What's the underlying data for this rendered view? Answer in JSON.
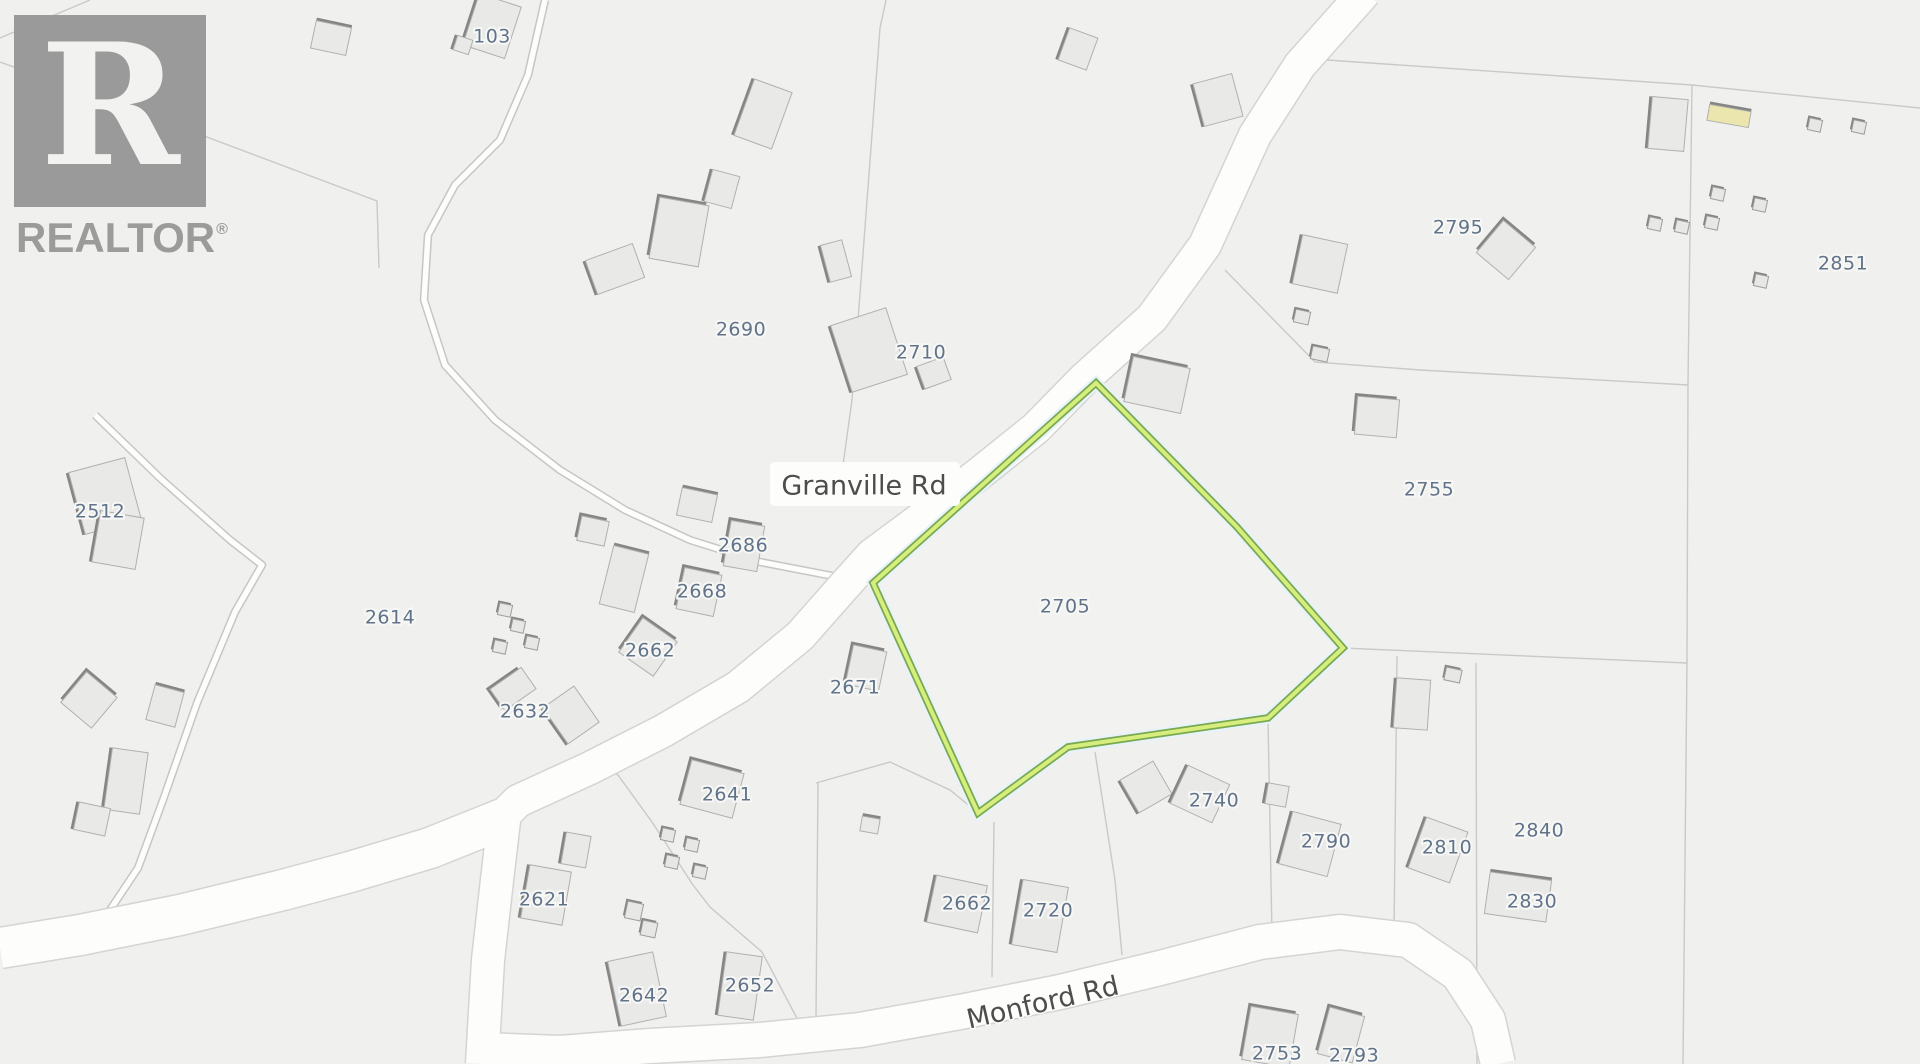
{
  "logo": {
    "letter": "R",
    "text": "REALTOR",
    "reg": "®",
    "color": "#9b9b99"
  },
  "map": {
    "background": "#f0f0ee",
    "parcel_fill": "#f2f2f0",
    "parcel_line_color": "#c9c9c7",
    "road_fill": "#fdfdfc",
    "road_casing": "#d4d4d2",
    "lane_casing": "#c6c6c4",
    "house_fill": "#e9e9e7",
    "house_stroke": "#b0b0ae",
    "house_accent": "#858583",
    "shed_fill": "#e7e7e5",
    "shed_stroke": "#9d9d9b",
    "label_color": "#60738a",
    "road_label_color": "#4d4d4b",
    "highlight_outer": "#79a94f",
    "highlight_inner": "#d7ee7e",
    "highlight_halo": "#e8f2fa"
  },
  "highlight_parcel": {
    "id": "2705",
    "points": "1096,383 1237,527 1343,648 1268,718 1068,747 978,813 873,583"
  },
  "road_labels": [
    {
      "text": "Granville Rd",
      "x": 864,
      "y": 487,
      "rot": 0,
      "pill": {
        "x": 770,
        "y": 462,
        "w": 190,
        "h": 44
      }
    },
    {
      "text": "Monford Rd",
      "x": 1043,
      "y": 1004,
      "rot": -13
    }
  ],
  "parcel_labels": [
    {
      "text": "103",
      "x": 492,
      "y": 37
    },
    {
      "text": "2690",
      "x": 741,
      "y": 330
    },
    {
      "text": "2710",
      "x": 921,
      "y": 353
    },
    {
      "text": "2795",
      "x": 1458,
      "y": 228
    },
    {
      "text": "2851",
      "x": 1843,
      "y": 264
    },
    {
      "text": "2755",
      "x": 1429,
      "y": 490
    },
    {
      "text": "2705",
      "x": 1065,
      "y": 607
    },
    {
      "text": "2512",
      "x": 100,
      "y": 512
    },
    {
      "text": "2614",
      "x": 390,
      "y": 618
    },
    {
      "text": "2686",
      "x": 743,
      "y": 546
    },
    {
      "text": "2668",
      "x": 702,
      "y": 592
    },
    {
      "text": "2662",
      "x": 650,
      "y": 651
    },
    {
      "text": "2632",
      "x": 525,
      "y": 712
    },
    {
      "text": "2671",
      "x": 855,
      "y": 688
    },
    {
      "text": "2641",
      "x": 727,
      "y": 795
    },
    {
      "text": "2621",
      "x": 544,
      "y": 900
    },
    {
      "text": "2642",
      "x": 644,
      "y": 996
    },
    {
      "text": "2652",
      "x": 750,
      "y": 986
    },
    {
      "text": "2662",
      "x": 967,
      "y": 904
    },
    {
      "text": "2720",
      "x": 1048,
      "y": 911
    },
    {
      "text": "2740",
      "x": 1214,
      "y": 801
    },
    {
      "text": "2790",
      "x": 1326,
      "y": 842
    },
    {
      "text": "2810",
      "x": 1447,
      "y": 848
    },
    {
      "text": "2840",
      "x": 1539,
      "y": 831
    },
    {
      "text": "2830",
      "x": 1532,
      "y": 902
    },
    {
      "text": "2753",
      "x": 1277,
      "y": 1054
    },
    {
      "text": "2793",
      "x": 1354,
      "y": 1056
    }
  ],
  "roads": [
    {
      "name": "granville-rd",
      "w": 32,
      "d": "M1365,-8 L1300,65 L1255,135 L1205,245 L1152,318 L1085,378 L1036,428 L980,473 L930,512 L872,555 L845,585 L800,636 L738,687 L663,731 L588,769 L518,801 L505,814"
    },
    {
      "name": "junction-south",
      "w": 32,
      "d": "M505,812 L497,880 L488,960 L482,1064"
    },
    {
      "name": "west-road",
      "w": 40,
      "d": "M505,818 L430,848 L350,872 L283,890 L180,915 L80,935 L0,948"
    },
    {
      "name": "monford-rd",
      "w": 34,
      "d": "M482,1050 L560,1053 L650,1046 L760,1040 L860,1030 L960,1012 L1060,992 L1160,968 L1260,942 L1340,932 L1408,940 L1458,974 L1488,1020 L1498,1064"
    }
  ],
  "lanes": [
    {
      "name": "lane-103",
      "d": "M545,0 L528,75 L500,140 L455,185 L428,235 L424,300 L445,365 L495,420 L560,470 L625,510 L690,540 L760,562 L843,578"
    },
    {
      "name": "lane-west",
      "d": "M95,415 L160,478 L230,540 L262,565 L235,612 L197,703 L163,800 L138,868 L100,925"
    }
  ],
  "boundaries": [
    "M90,0 L0,38",
    "M0,62 L180,127 L377,201 L379,268",
    "M886,0 L880,28 L852,400 L843,465",
    "M1327,60 L1692,85 L1920,108",
    "M1692,85 L1688,383 L1687,660 L1683,1064",
    "M1225,270 L1315,362 L1420,370 L1688,385",
    "M1343,648 L1687,663",
    "M1268,718 L1272,935",
    "M1397,656 L1394,935",
    "M1476,663 L1477,1064",
    "M600,762 L618,775 L652,822 L693,885 L710,907 L762,952 L800,1024",
    "M818,783 L816,1017",
    "M994,822 L992,977",
    "M816,783 L890,762 L950,790 L978,813",
    "M1095,752 L1115,880 L1122,955"
  ],
  "houses": [
    {
      "x": 492,
      "y": 26,
      "w": 44,
      "h": 54,
      "r": 18,
      "a": "left"
    },
    {
      "x": 463,
      "y": 45,
      "w": 16,
      "h": 15,
      "r": 18,
      "a": "left"
    },
    {
      "x": 331,
      "y": 38,
      "w": 36,
      "h": 28,
      "r": 12,
      "a": "top"
    },
    {
      "x": 763,
      "y": 114,
      "w": 40,
      "h": 60,
      "r": 20,
      "a": "left"
    },
    {
      "x": 722,
      "y": 189,
      "w": 28,
      "h": 33,
      "r": 15,
      "a": "left"
    },
    {
      "x": 679,
      "y": 232,
      "w": 50,
      "h": 62,
      "r": 10,
      "a": "topleft"
    },
    {
      "x": 615,
      "y": 269,
      "w": 50,
      "h": 36,
      "r": -20,
      "a": "left"
    },
    {
      "x": 869,
      "y": 350,
      "w": 58,
      "h": 70,
      "r": -18,
      "a": "left"
    },
    {
      "x": 836,
      "y": 261,
      "w": 22,
      "h": 38,
      "r": -15,
      "a": "left"
    },
    {
      "x": 934,
      "y": 373,
      "w": 28,
      "h": 24,
      "r": -20,
      "a": "left"
    },
    {
      "x": 1078,
      "y": 49,
      "w": 30,
      "h": 34,
      "r": 20,
      "a": "left"
    },
    {
      "x": 1218,
      "y": 100,
      "w": 40,
      "h": 44,
      "r": -15,
      "a": "left"
    },
    {
      "x": 1157,
      "y": 385,
      "w": 58,
      "h": 46,
      "r": 12,
      "a": "topleft"
    },
    {
      "x": 1320,
      "y": 264,
      "w": 46,
      "h": 50,
      "r": 12,
      "a": "left"
    },
    {
      "x": 1506,
      "y": 250,
      "w": 42,
      "h": 42,
      "r": 40,
      "a": "topleft"
    },
    {
      "x": 1668,
      "y": 124,
      "w": 36,
      "h": 52,
      "r": 5,
      "a": "left"
    },
    {
      "x": 1729,
      "y": 116,
      "w": 42,
      "h": 16,
      "r": 10,
      "a": "top",
      "f": "#eae6ad"
    },
    {
      "x": 1377,
      "y": 417,
      "w": 42,
      "h": 38,
      "r": 5,
      "a": "topleft"
    },
    {
      "x": 1412,
      "y": 704,
      "w": 34,
      "h": 50,
      "r": 4,
      "a": "left"
    },
    {
      "x": 105,
      "y": 496,
      "w": 58,
      "h": 64,
      "r": -15,
      "a": "left"
    },
    {
      "x": 118,
      "y": 540,
      "w": 44,
      "h": 52,
      "r": 10,
      "a": "left"
    },
    {
      "x": 89,
      "y": 700,
      "w": 40,
      "h": 40,
      "r": 40,
      "a": "topleft"
    },
    {
      "x": 165,
      "y": 706,
      "w": 30,
      "h": 36,
      "r": 15,
      "a": "top"
    },
    {
      "x": 126,
      "y": 781,
      "w": 36,
      "h": 62,
      "r": 8,
      "a": "left"
    },
    {
      "x": 92,
      "y": 819,
      "w": 32,
      "h": 28,
      "r": 12,
      "a": "left"
    },
    {
      "x": 593,
      "y": 531,
      "w": 28,
      "h": 25,
      "r": 12,
      "a": "topleft"
    },
    {
      "x": 624,
      "y": 579,
      "w": 36,
      "h": 60,
      "r": 14,
      "a": "top"
    },
    {
      "x": 697,
      "y": 505,
      "w": 36,
      "h": 28,
      "r": 12,
      "a": "top"
    },
    {
      "x": 744,
      "y": 546,
      "w": 34,
      "h": 46,
      "r": 10,
      "a": "topleft"
    },
    {
      "x": 699,
      "y": 592,
      "w": 38,
      "h": 42,
      "r": 12,
      "a": "topleft"
    },
    {
      "x": 648,
      "y": 647,
      "w": 42,
      "h": 42,
      "r": 35,
      "a": "topleft"
    },
    {
      "x": 513,
      "y": 689,
      "w": 38,
      "h": 26,
      "r": -35,
      "a": "topleft"
    },
    {
      "x": 571,
      "y": 715,
      "w": 38,
      "h": 44,
      "r": -35,
      "a": "left"
    },
    {
      "x": 866,
      "y": 668,
      "w": 34,
      "h": 40,
      "r": 12,
      "a": "topleft"
    },
    {
      "x": 712,
      "y": 789,
      "w": 54,
      "h": 46,
      "r": 15,
      "a": "topleft"
    },
    {
      "x": 546,
      "y": 895,
      "w": 42,
      "h": 54,
      "r": 10,
      "a": "left"
    },
    {
      "x": 576,
      "y": 850,
      "w": 25,
      "h": 32,
      "r": 10,
      "a": "left"
    },
    {
      "x": 637,
      "y": 989,
      "w": 46,
      "h": 66,
      "r": -12,
      "a": "left"
    },
    {
      "x": 740,
      "y": 986,
      "w": 36,
      "h": 64,
      "r": 8,
      "a": "left"
    },
    {
      "x": 957,
      "y": 904,
      "w": 52,
      "h": 48,
      "r": 12,
      "a": "left"
    },
    {
      "x": 1040,
      "y": 916,
      "w": 46,
      "h": 66,
      "r": 10,
      "a": "left"
    },
    {
      "x": 1146,
      "y": 787,
      "w": 38,
      "h": 38,
      "r": -30,
      "a": "left"
    },
    {
      "x": 1200,
      "y": 794,
      "w": 46,
      "h": 42,
      "r": 25,
      "a": "left"
    },
    {
      "x": 1310,
      "y": 844,
      "w": 50,
      "h": 54,
      "r": 15,
      "a": "left"
    },
    {
      "x": 1277,
      "y": 795,
      "w": 21,
      "h": 21,
      "r": 10,
      "a": "left"
    },
    {
      "x": 1438,
      "y": 850,
      "w": 44,
      "h": 54,
      "r": 20,
      "a": "left"
    },
    {
      "x": 1518,
      "y": 897,
      "w": 62,
      "h": 42,
      "r": 8,
      "a": "top"
    },
    {
      "x": 1270,
      "y": 1037,
      "w": 48,
      "h": 54,
      "r": 10,
      "a": "topleft"
    },
    {
      "x": 1341,
      "y": 1035,
      "w": 36,
      "h": 48,
      "r": 15,
      "a": "topleft"
    },
    {
      "x": 870,
      "y": 825,
      "w": 18,
      "h": 15,
      "r": 10,
      "a": "top"
    }
  ],
  "sheds": [
    {
      "x": 505,
      "y": 610
    },
    {
      "x": 518,
      "y": 626
    },
    {
      "x": 532,
      "y": 643
    },
    {
      "x": 500,
      "y": 647
    },
    {
      "x": 668,
      "y": 835
    },
    {
      "x": 692,
      "y": 845
    },
    {
      "x": 672,
      "y": 862
    },
    {
      "x": 700,
      "y": 872
    },
    {
      "x": 634,
      "y": 911,
      "w": 16,
      "h": 17
    },
    {
      "x": 649,
      "y": 929,
      "w": 15,
      "h": 15
    },
    {
      "x": 1302,
      "y": 317,
      "w": 15,
      "h": 13
    },
    {
      "x": 1320,
      "y": 354,
      "w": 17,
      "h": 13
    },
    {
      "x": 1718,
      "y": 194
    },
    {
      "x": 1760,
      "y": 205
    },
    {
      "x": 1712,
      "y": 223
    },
    {
      "x": 1655,
      "y": 224
    },
    {
      "x": 1682,
      "y": 227
    },
    {
      "x": 1761,
      "y": 281
    },
    {
      "x": 1815,
      "y": 125
    },
    {
      "x": 1859,
      "y": 127
    },
    {
      "x": 1453,
      "y": 675,
      "w": 16,
      "h": 13
    }
  ]
}
